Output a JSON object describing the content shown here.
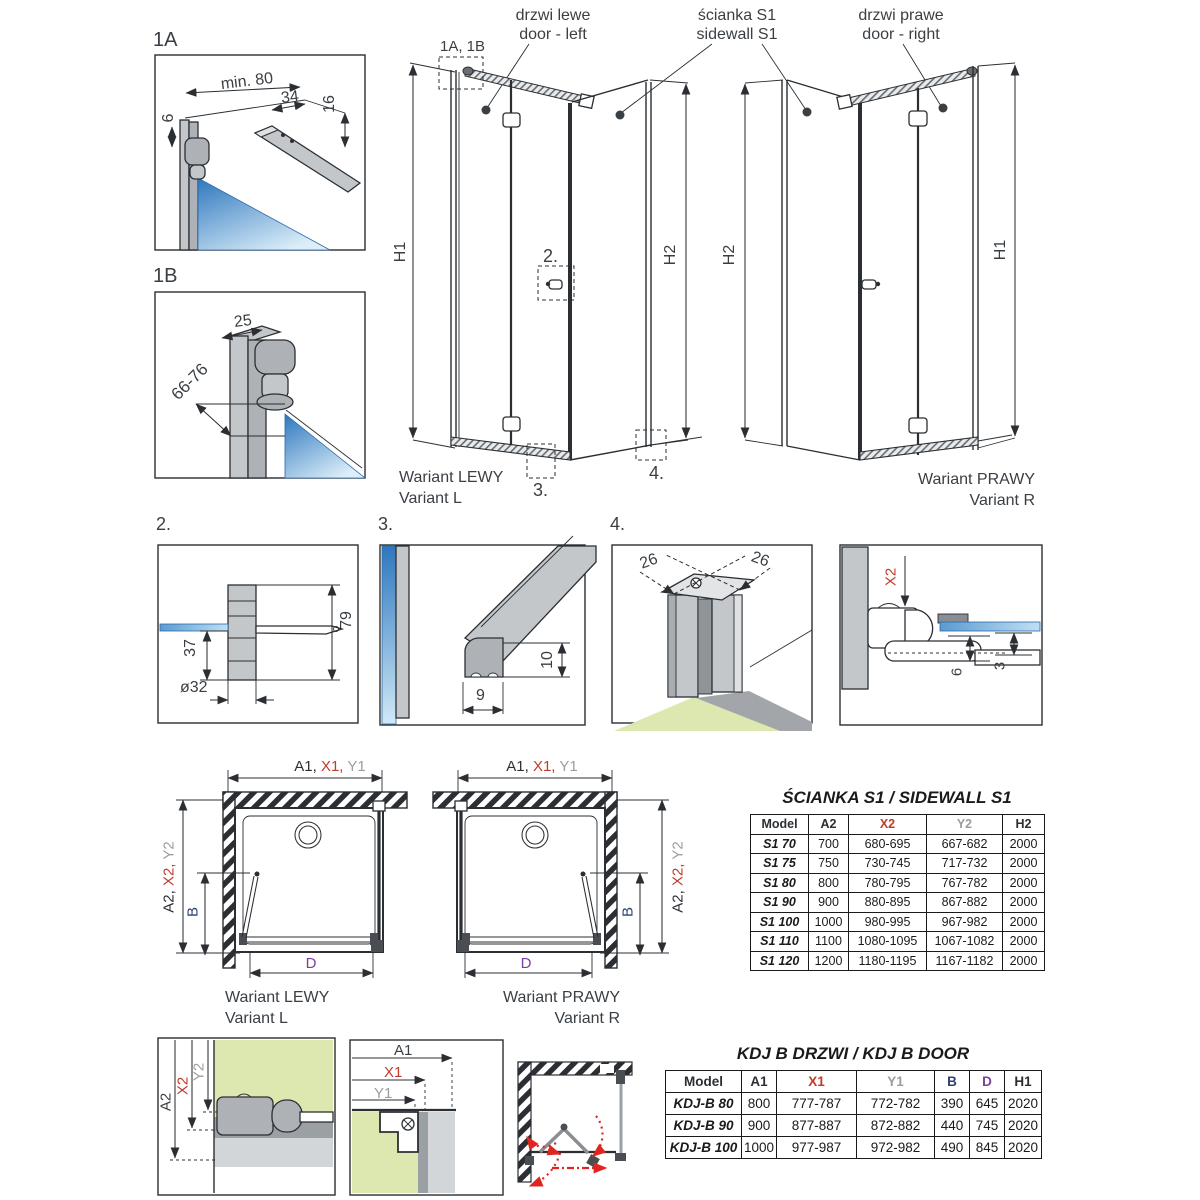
{
  "colors": {
    "accent_red": "#bf3b2b",
    "label_gray": "#9a9ea2",
    "navy": "#2e4374",
    "purple": "#7a3fa0",
    "glass_blue": "#2e77bd",
    "glass_light": "#dceef9",
    "floor_green": "#dde8b0",
    "profile_gray": "#c3c7ca"
  },
  "callouts": {
    "door_left_pl": "drzwi lewe",
    "door_left_en": "door - left",
    "sidewall_pl": "ścianka S1",
    "sidewall_en": "sidewall S1",
    "door_right_pl": "drzwi prawe",
    "door_right_en": "door - right"
  },
  "elev_left": {
    "ref_1a1b": "1A, 1B",
    "h1": "H1",
    "h2": "H2",
    "ref2": "2.",
    "ref3": "3.",
    "ref4": "4.",
    "caption_pl": "Wariant LEWY",
    "caption_en": "Variant L"
  },
  "elev_right": {
    "h1": "H1",
    "h2": "H2",
    "caption_pl": "Wariant PRAWY",
    "caption_en": "Variant R"
  },
  "d1a": {
    "label": "1A",
    "min80": "min. 80",
    "d34": "34",
    "d16": "16",
    "d6": "6"
  },
  "d1b": {
    "label": "1B",
    "d25": "25",
    "d6676": "66-76"
  },
  "d2": {
    "label": "2.",
    "d37": "37",
    "d79": "79",
    "d32": "ø32"
  },
  "d3": {
    "label": "3.",
    "d9": "9",
    "d10": "10"
  },
  "d4": {
    "label": "4.",
    "d26a": "26",
    "d26b": "26"
  },
  "d5": {
    "x2": "X2",
    "d6": "6",
    "d3": "3"
  },
  "plan_left": {
    "a1": "A1,",
    "x1": "X1,",
    "y1": "Y1",
    "a2": "A2,",
    "x2": "X2,",
    "y2": "Y2",
    "b": "B",
    "d": "D",
    "caption_pl": "Wariant LEWY",
    "caption_en": "Variant L"
  },
  "plan_right": {
    "a1": "A1,",
    "x1": "X1,",
    "y1": "Y1",
    "a2": "A2,",
    "x2": "X2,",
    "y2": "Y2",
    "b": "B",
    "d": "D",
    "caption_pl": "Wariant PRAWY",
    "caption_en": "Variant R"
  },
  "da2": {
    "a2": "A2",
    "x2": "X2",
    "y2": "Y2"
  },
  "da1": {
    "a1": "A1",
    "x1": "X1",
    "y1": "Y1"
  },
  "sidewall_table": {
    "title": "ŚCIANKA S1 / SIDEWALL S1",
    "headers": [
      "Model",
      "A2",
      "X2",
      "Y2",
      "H2"
    ],
    "rows": [
      [
        "S1 70",
        "700",
        "680-695",
        "667-682",
        "2000"
      ],
      [
        "S1 75",
        "750",
        "730-745",
        "717-732",
        "2000"
      ],
      [
        "S1 80",
        "800",
        "780-795",
        "767-782",
        "2000"
      ],
      [
        "S1 90",
        "900",
        "880-895",
        "867-882",
        "2000"
      ],
      [
        "S1 100",
        "1000",
        "980-995",
        "967-982",
        "2000"
      ],
      [
        "S1 110",
        "1100",
        "1080-1095",
        "1067-1082",
        "2000"
      ],
      [
        "S1 120",
        "1200",
        "1180-1195",
        "1167-1182",
        "2000"
      ]
    ]
  },
  "door_table": {
    "title": "KDJ B DRZWI / KDJ B DOOR",
    "headers": [
      "Model",
      "A1",
      "X1",
      "Y1",
      "B",
      "D",
      "H1"
    ],
    "rows": [
      [
        "KDJ-B 80",
        "800",
        "777-787",
        "772-782",
        "390",
        "645",
        "2020"
      ],
      [
        "KDJ-B 90",
        "900",
        "877-887",
        "872-882",
        "440",
        "745",
        "2020"
      ],
      [
        "KDJ-B 100",
        "1000",
        "977-987",
        "972-982",
        "490",
        "845",
        "2020"
      ]
    ]
  }
}
